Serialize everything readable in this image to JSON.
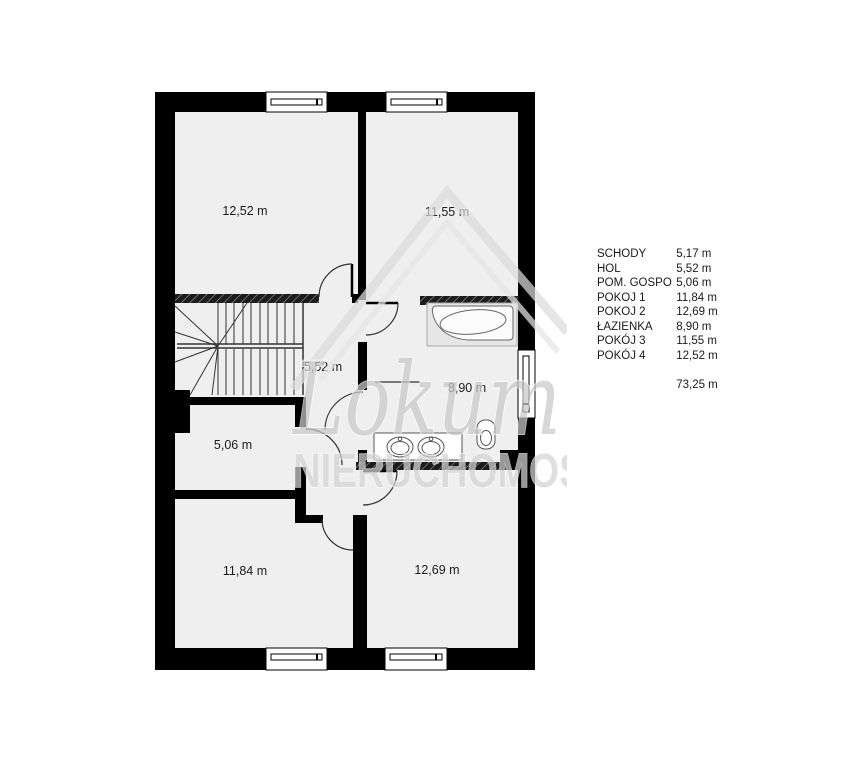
{
  "plan_labels": {
    "room_top_left": "12,52 m",
    "room_top_right": "11,55 m",
    "hall": "5,52 m",
    "bathroom": "8,90 m",
    "utility": "5,06 m",
    "room_bottom_left": "11,84 m",
    "room_bottom_right": "12,69 m"
  },
  "watermark": {
    "brand": "Lokum",
    "subtitle": "NIERUCHOMOŚCI"
  },
  "legend": {
    "rows": [
      {
        "name": "SCHODY",
        "area": "5,17 m"
      },
      {
        "name": "HOL",
        "area": "5,52 m"
      },
      {
        "name": "POM. GOSPO",
        "area": "5,06 m"
      },
      {
        "name": "POKOJ 1",
        "area": "11,84 m"
      },
      {
        "name": "POKOJ 2",
        "area": "12,69 m"
      },
      {
        "name": "ŁAZIENKA",
        "area": "8,90 m"
      },
      {
        "name": "POKÓJ 3",
        "area": "11,55 m"
      },
      {
        "name": "POKÓJ 4",
        "area": "12,52 m"
      }
    ],
    "total_area": "73,25 m"
  },
  "colors": {
    "wall": "#000000",
    "floor": "#efefef",
    "watermark": "#d6d6d6"
  }
}
